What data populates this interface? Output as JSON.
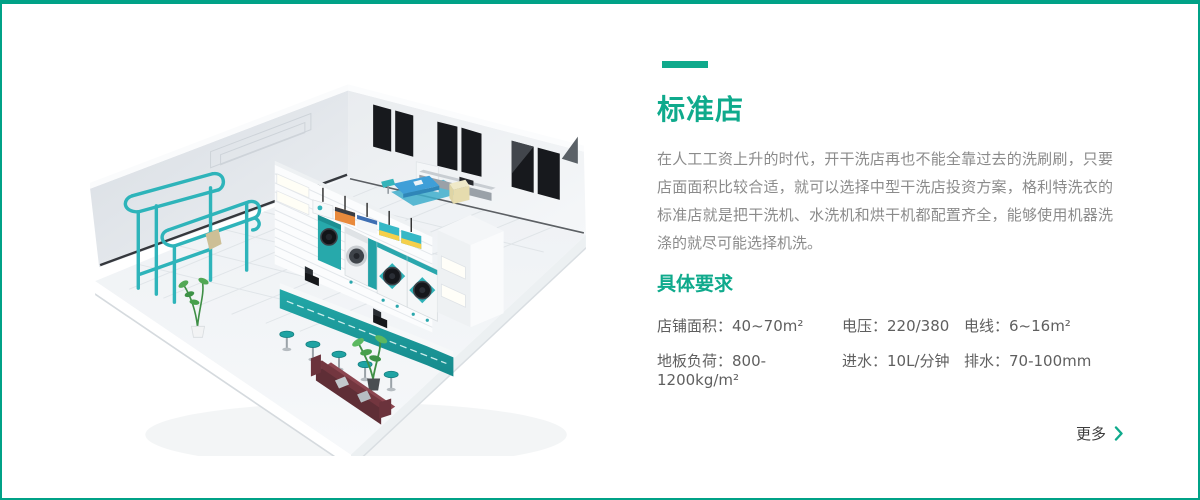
{
  "page": {
    "border_color": "#00A287",
    "background": "#FFFFFF"
  },
  "content": {
    "title": "标准店",
    "description": "在人工工资上升的时代，开干洗店再也不能全靠过去的洗刷刷，只要店面面积比较合适，就可以选择中型干洗店投资方案，格利特洗衣的标准店就是把干洗机、水洗机和烘干机都配置齐全，能够使用机器洗涤的就尽可能选择机洗。",
    "requirements": {
      "heading": "具体要求",
      "items": [
        "店铺面积：40~70m²",
        "电压：220/380",
        "电线：6~16m²",
        "地板负荷：800-1200kg/m²",
        "进水：10L/分钟",
        "排水：70-100mm"
      ]
    },
    "more_link": {
      "label": "更多"
    }
  },
  "illustration": {
    "name": "laundry-store-3d-isometric-render",
    "accent_teal": "#2EB4BA",
    "counter_teal": "#1FA3A3",
    "sofa_maroon": "#6B333C"
  },
  "colors": {
    "accent_green": "#0FAA8C",
    "text_gray": "#8B8B8B",
    "spec_gray": "#5F5F5F"
  }
}
